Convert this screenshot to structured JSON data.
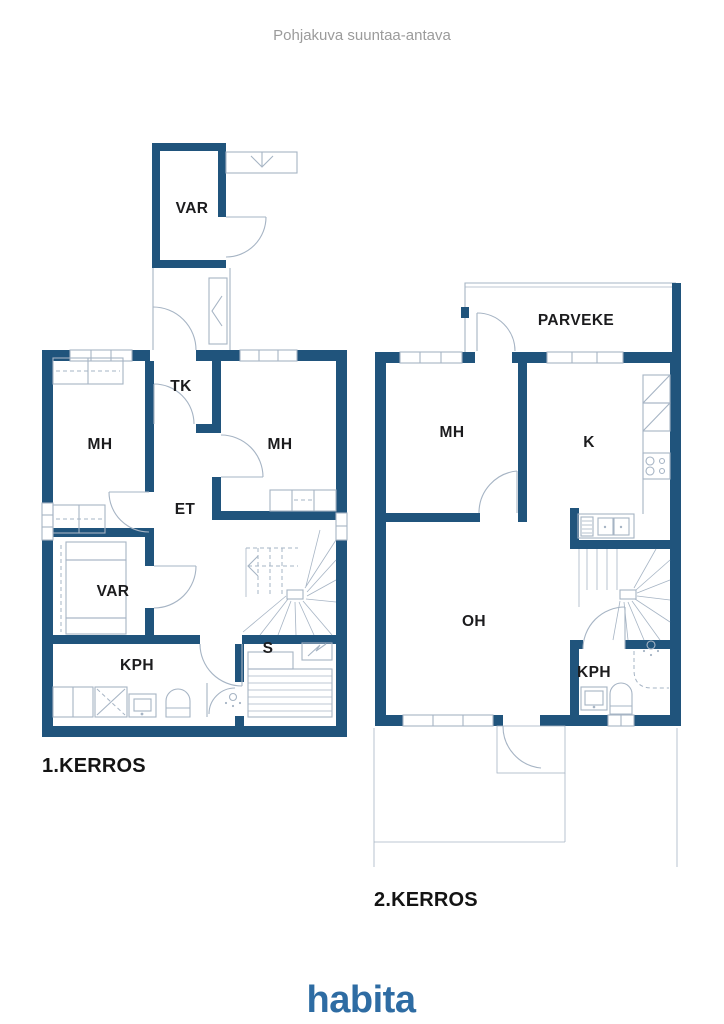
{
  "header": {
    "disclaimer": "Pohjakuva suuntaa-antava"
  },
  "floor1": {
    "title": "1.KERROS",
    "labels": {
      "var_storage": "VAR",
      "tk": "TK",
      "mh_left": "MH",
      "mh_right": "MH",
      "et": "ET",
      "var": "VAR",
      "kph": "KPH",
      "s": "S"
    }
  },
  "floor2": {
    "title": "2.KERROS",
    "labels": {
      "parveke": "PARVEKE",
      "mh": "MH",
      "k": "K",
      "oh": "OH",
      "kph": "KPH"
    }
  },
  "brand": {
    "logo": "habita"
  },
  "colors": {
    "wall": "#20547c",
    "thin_line": "#a6b4c4",
    "label_text": "#1c1c1e",
    "title_text": "#141414",
    "disclaimer_text": "#9b9b9b",
    "logo_blue": "#2e6ca3",
    "background": "#ffffff"
  }
}
